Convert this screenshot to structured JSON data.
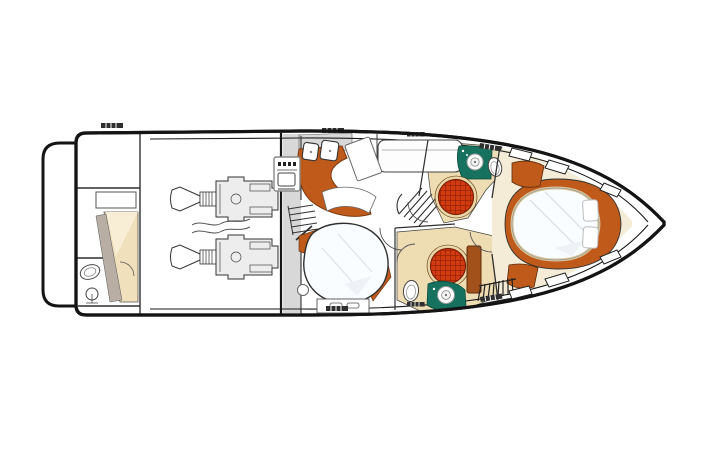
{
  "figure": {
    "type": "yacht-deck-plan",
    "orientation": "bow-right",
    "description": "Top-down lower-deck interior layout plan of a motor yacht"
  },
  "colors": {
    "background": "#ffffff",
    "hull_outline": "#141414",
    "wall_line": "#2f2f2f",
    "deck_gray": "#d8d8d8",
    "engine_gray": "#ededed",
    "cabinet_orange": "#bf5a1b",
    "cabinet_dark": "#a2511a",
    "trim_brown": "#5d2c0c",
    "vanity_teal": "#16725e",
    "shower_red": "#d23a10",
    "shower_grid": "#8d1f04",
    "shower_rim": "#e9d5a6",
    "carpet_beige": "#eedcb2",
    "carpet_cream": "#f4ecd6",
    "bed_beige": "#f0e0bb",
    "bed_white": "#fafdff",
    "bed_fold": "#dde3ea",
    "bed_rim": "#d8c59a",
    "wedge_gray": "#b9aea4"
  },
  "regions": [
    "swim-platform",
    "crew-cabin",
    "engine-room",
    "galley",
    "companionway",
    "guest-cabin",
    "mid-head",
    "forward-head",
    "master-cabin",
    "foredeck"
  ],
  "fixtures": [
    "engine",
    "double-sink",
    "stove",
    "shower-grate",
    "vanity-sink",
    "toilet",
    "island-bed",
    "double-bed",
    "single-bed",
    "wardrobe-hangers",
    "stairs",
    "deck-hatch",
    "cleat-marker"
  ]
}
